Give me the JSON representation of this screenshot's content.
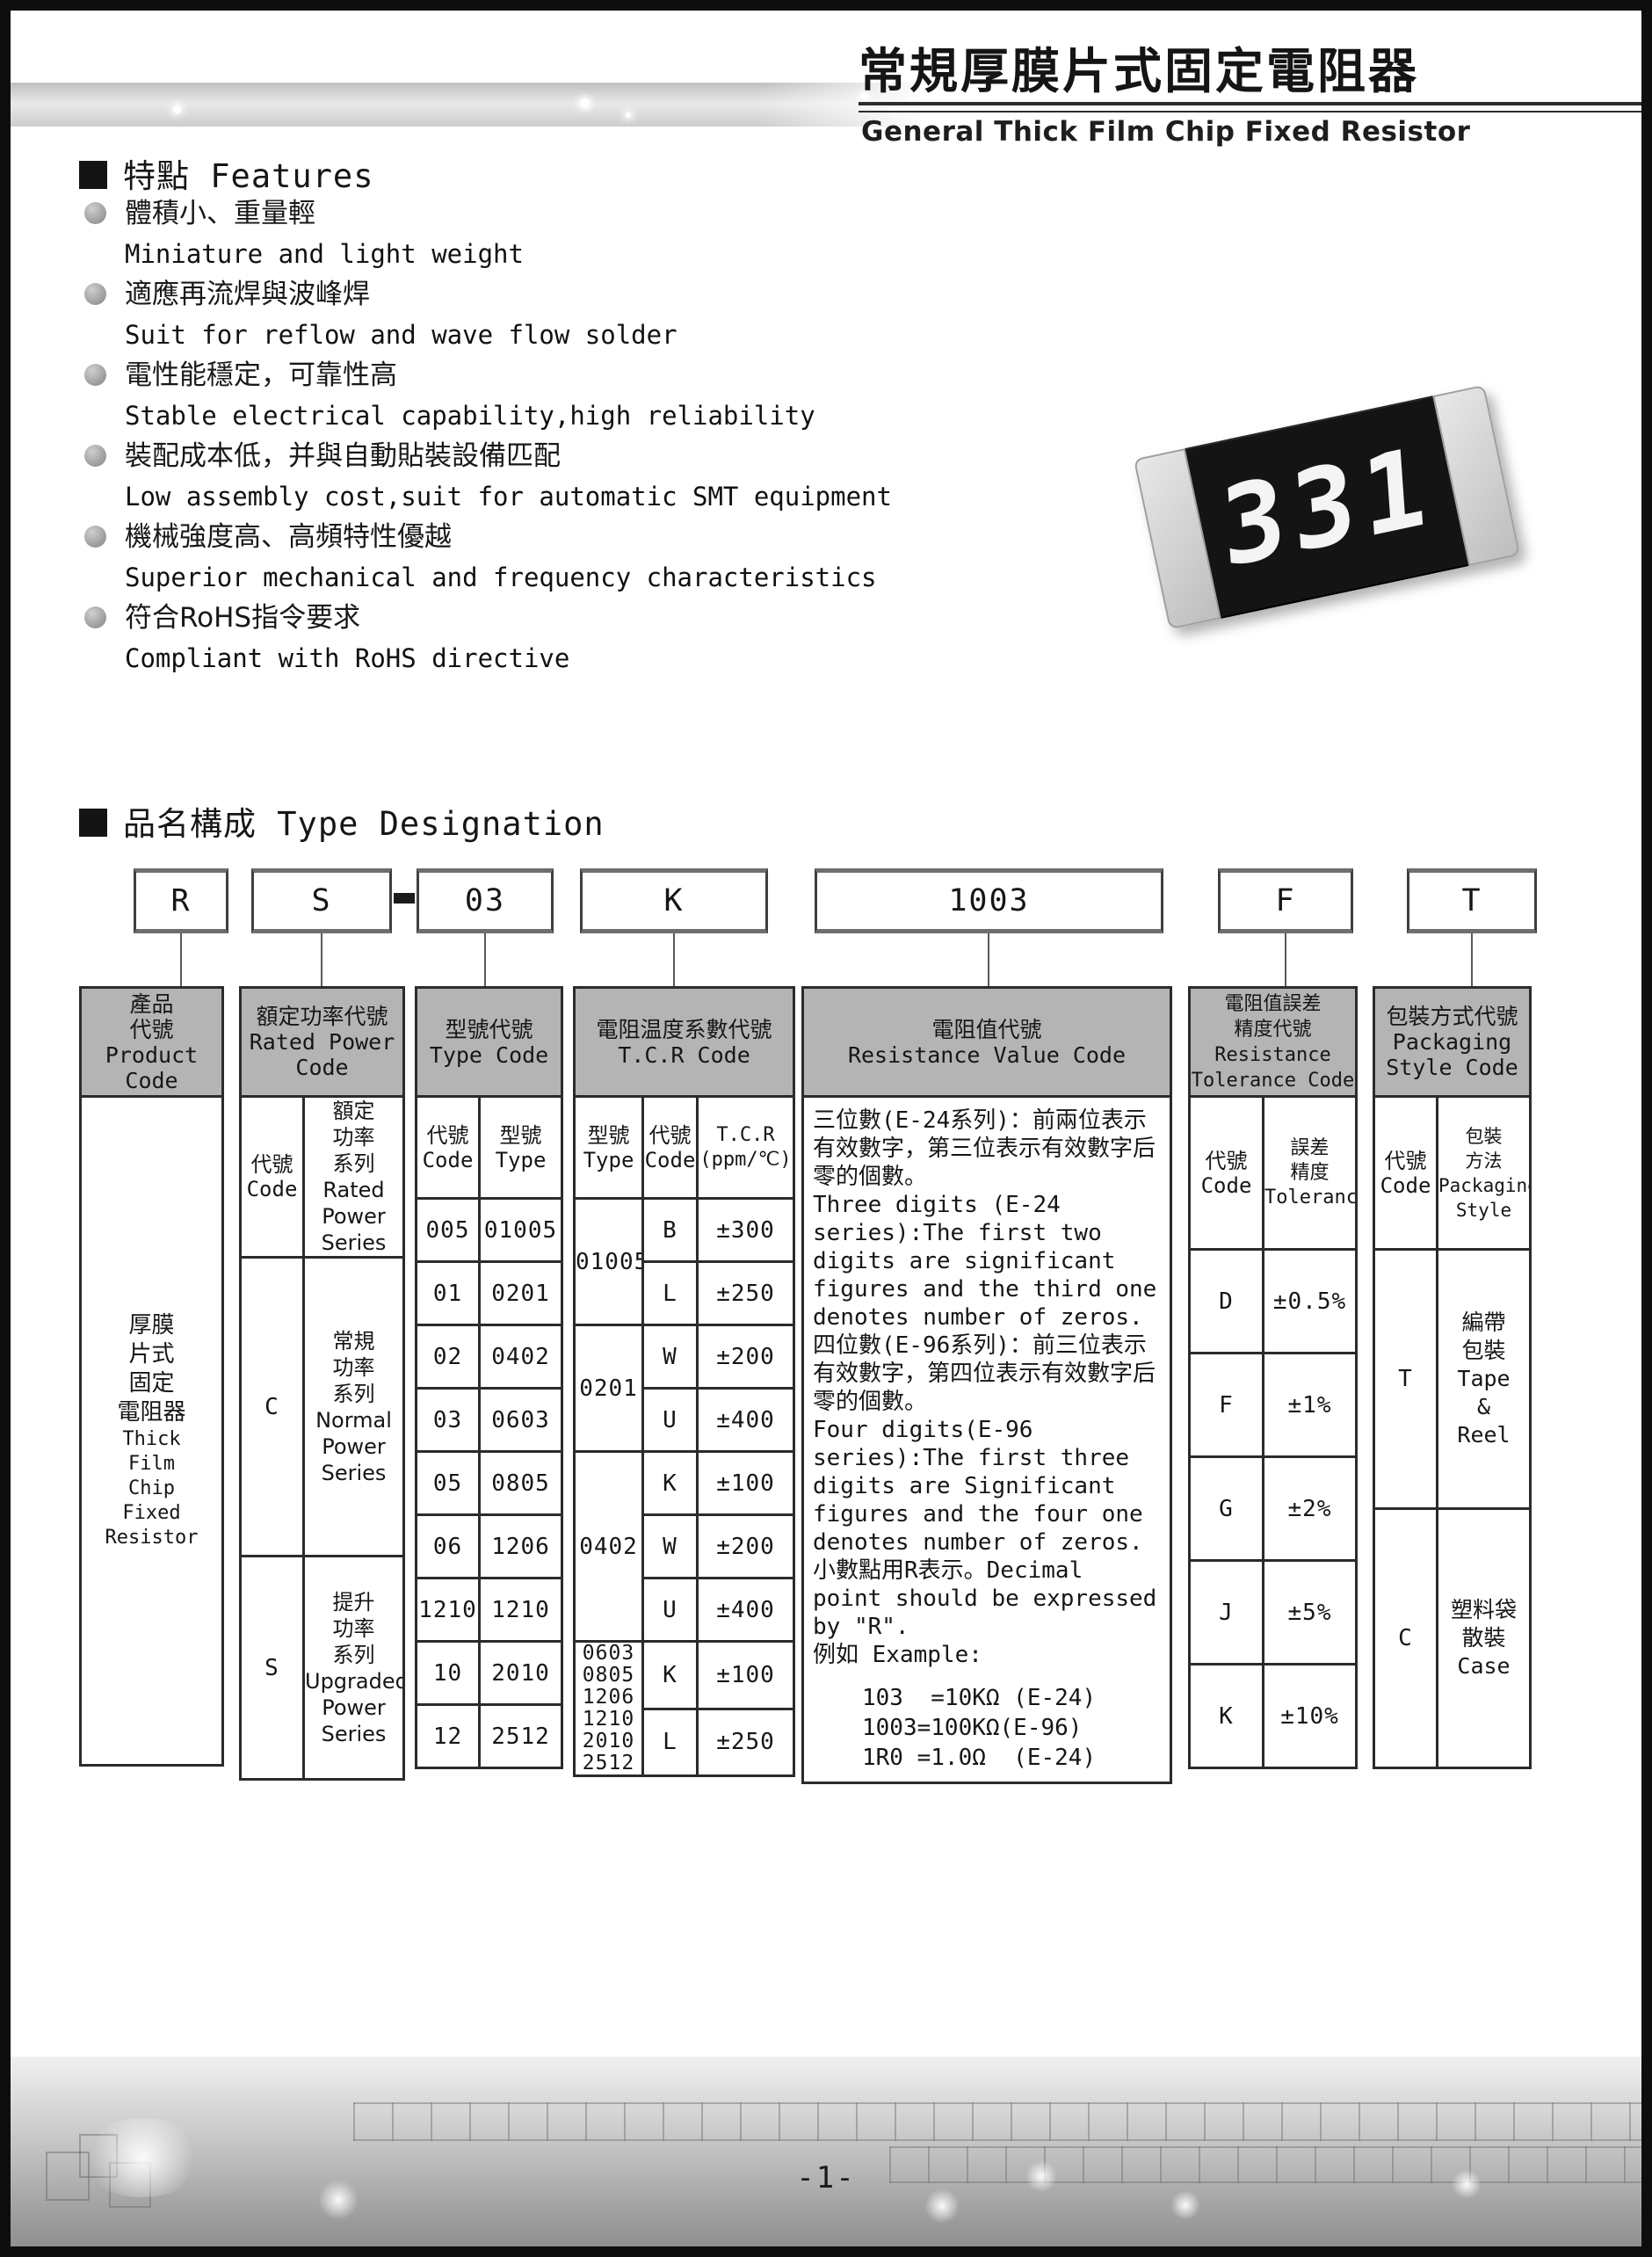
{
  "page": {
    "number": "-1-"
  },
  "masthead": {
    "title_cn": "常規厚膜片式固定電阻器",
    "title_en": "General Thick Film Chip Fixed Resistor"
  },
  "features": {
    "heading": "特點 Features",
    "items": [
      {
        "cn": "體積小、重量輕",
        "en": "Miniature and light weight"
      },
      {
        "cn": "適應再流焊與波峰焊",
        "en": "Suit for reflow and wave flow solder"
      },
      {
        "cn": "電性能穩定，可靠性高",
        "en": "Stable electrical capability,high reliability"
      },
      {
        "cn": "裝配成本低，并與自動貼裝設備匹配",
        "en": "Low assembly cost,suit for automatic SMT equipment"
      },
      {
        "cn": "機械強度高、高頻特性優越",
        "en": "Superior mechanical and frequency characteristics"
      },
      {
        "cn": "符合RoHS指令要求",
        "en": "Compliant with RoHS directive"
      }
    ]
  },
  "product_photo": {
    "marking": "331"
  },
  "type_designation": {
    "heading": "品名構成  Type Designation",
    "example_code": {
      "product": "R",
      "power": "S",
      "separator": "—",
      "type": "03",
      "tcr": "K",
      "resistance": "1003",
      "tolerance": "F",
      "packaging": "T"
    },
    "product_code": {
      "header": "產品\n代號\nProduct\nCode",
      "value_cn": "厚膜\n片式\n固定\n電阻器",
      "value_en": "Thick\nFilm\nChip\nFixed\nResistor"
    },
    "rated_power": {
      "header": "額定功率代號\nRated Power\nCode",
      "col_code": "代號\nCode",
      "col_series": "額定\n功率\n系列\nRated\nPower\nSeries",
      "rows": [
        {
          "code": "C",
          "series": "常規\n功率\n系列\nNormal\nPower\nSeries"
        },
        {
          "code": "S",
          "series": "提升\n功率\n系列\nUpgraded\nPower\nSeries"
        }
      ]
    },
    "type_code": {
      "header": "型號代號\nType Code",
      "col_code": "代號\nCode",
      "col_type": "型號\nType",
      "rows": [
        {
          "code": "005",
          "type": "01005"
        },
        {
          "code": "01",
          "type": "0201"
        },
        {
          "code": "02",
          "type": "0402"
        },
        {
          "code": "03",
          "type": "0603"
        },
        {
          "code": "05",
          "type": "0805"
        },
        {
          "code": "06",
          "type": "1206"
        },
        {
          "code": "1210",
          "type": "1210"
        },
        {
          "code": "10",
          "type": "2010"
        },
        {
          "code": "12",
          "type": "2512"
        }
      ]
    },
    "tcr_code": {
      "header": "電阻温度系數代號\nT.C.R Code",
      "col_type": "型號\nType",
      "col_code": "代號\nCode",
      "col_tcr": "T.C.R\n(ppm/℃)",
      "groups": [
        {
          "type": "01005",
          "rows": [
            {
              "code": "B",
              "tcr": "±300"
            },
            {
              "code": "L",
              "tcr": "±250"
            }
          ]
        },
        {
          "type": "0201",
          "rows": [
            {
              "code": "W",
              "tcr": "±200"
            },
            {
              "code": "U",
              "tcr": "±400"
            }
          ]
        },
        {
          "type": "0402",
          "rows": [
            {
              "code": "K",
              "tcr": "±100"
            },
            {
              "code": "W",
              "tcr": "±200"
            },
            {
              "code": "U",
              "tcr": "±400"
            }
          ]
        },
        {
          "type": "0603\n0805\n1206\n1210\n2010\n2512",
          "rows": [
            {
              "code": "K",
              "tcr": "±100"
            },
            {
              "code": "L",
              "tcr": "±250"
            }
          ]
        }
      ]
    },
    "resistance_value": {
      "header": "電阻值代號\nResistance Value Code",
      "p1_cn": "三位數(E-24系列)：前兩位表示有效數字，第三位表示有效數字后零的個數。",
      "p1_en": "Three digits (E-24 series):The first two digits are significant figures and the third one denotes number of zeros.",
      "p2_cn": "四位數(E-96系列)：前三位表示有效數字，第四位表示有效數字后零的個數。",
      "p2_en": "Four digits(E-96 series):The first three digits are Significant figures and the four one denotes number of zeros.",
      "p3": "小數點用R表示。Decimal point should be expressed by \"R\".",
      "p4": "例如 Example:",
      "examples": [
        "103  =10KΩ (E-24)",
        "1003=100KΩ(E-96)",
        "1R0 =1.0Ω  (E-24)"
      ]
    },
    "tolerance": {
      "header": "電阻值誤差\n精度代號\nResistance\nTolerance Code",
      "col_code": "代號\nCode",
      "col_tol": "誤差\n精度\nTolerance",
      "rows": [
        {
          "code": "D",
          "tol": "±0.5%"
        },
        {
          "code": "F",
          "tol": "±1%"
        },
        {
          "code": "G",
          "tol": "±2%"
        },
        {
          "code": "J",
          "tol": "±5%"
        },
        {
          "code": "K",
          "tol": "±10%"
        }
      ]
    },
    "packaging": {
      "header": "包裝方式代號\nPackaging\nStyle Code",
      "col_code": "代號\nCode",
      "col_style": "包裝\n方法\nPackaging\nStyle",
      "rows": [
        {
          "code": "T",
          "style": "編帶\n包裝\nTape\n&\nReel"
        },
        {
          "code": "C",
          "style": "塑料袋\n散裝\nCase"
        }
      ]
    }
  },
  "colors": {
    "header_fill": "#b4b4b4",
    "table_line": "#2b2b2b",
    "heading_black": "#141414",
    "bullet_gray": "#9a9a9a"
  }
}
